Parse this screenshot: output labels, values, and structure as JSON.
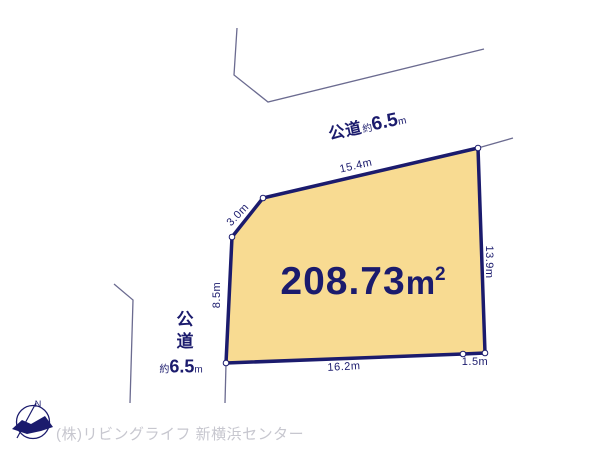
{
  "plot": {
    "area_value": "208.73",
    "area_unit": "m",
    "area_exponent": "2"
  },
  "dimensions": {
    "top_edge": "15.4m",
    "chamfer_edge": "3.0m",
    "left_edge": "8.5m",
    "right_edge": "13.9m",
    "bottom_edge": "16.2m",
    "bottom_right_edge": "1.5m"
  },
  "roads": {
    "top": {
      "name": "公道",
      "approx_prefix": "約",
      "width_value": "6.5",
      "width_unit": "m"
    },
    "left": {
      "name": "公道",
      "approx_prefix": "約",
      "width_value": "6.5",
      "width_unit": "m"
    }
  },
  "compass": {
    "north_label": "N"
  },
  "footer": {
    "company": "(株)リビングライフ 新横浜センター"
  },
  "colors": {
    "plot_fill": "#f8db92",
    "plot_border": "#1b1b6d",
    "thin_line": "#6b6b90",
    "text_navy": "#1b1b6d",
    "footer_gray": "#c7c7cf",
    "vertex_dot_fill": "#ffffff"
  }
}
